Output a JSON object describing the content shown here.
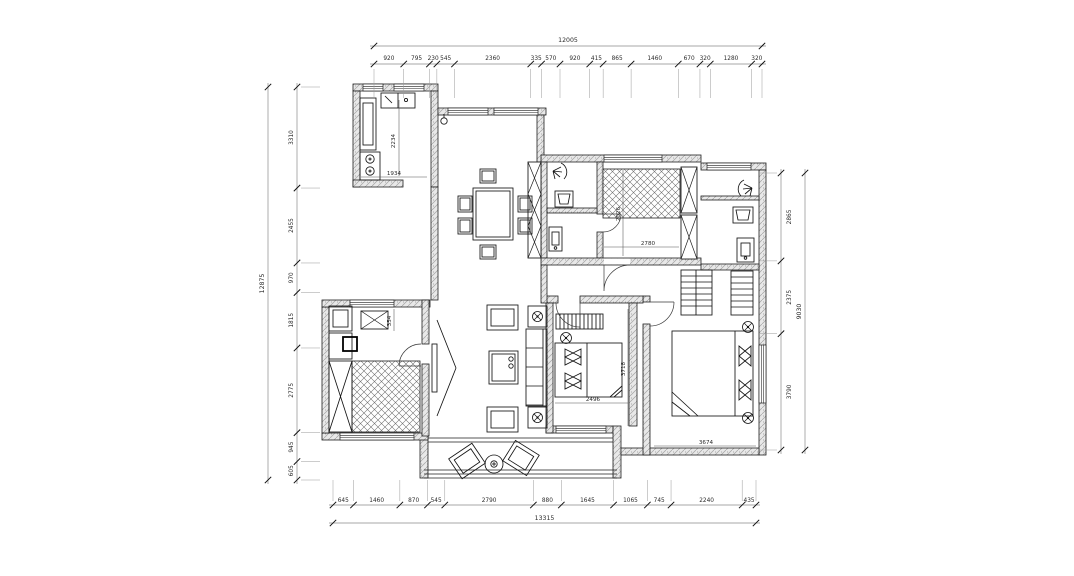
{
  "drawing": {
    "kind": "residential floor plan, dimensioned CAD drawing",
    "palette": {
      "background": "#ffffff",
      "wall_fill": "#e8e8e8",
      "wall_hatch": "#a3a3a3",
      "line": "#1f1f1f",
      "dim_line": "#8a8a8a",
      "dim_tick": "#111111",
      "dim_text": "#2a2a2a"
    },
    "dimensions": {
      "top": {
        "total": "12005",
        "segments": [
          "920",
          "795",
          "230",
          "545",
          "2360",
          "335",
          "570",
          "920",
          "415",
          "865",
          "1460",
          "670",
          "320",
          "1280",
          "320"
        ]
      },
      "bottom": {
        "total": "13315",
        "segments": [
          "645",
          "1460",
          "870",
          "545",
          "2790",
          "880",
          "1645",
          "1065",
          "745",
          "2240",
          "435"
        ]
      },
      "left": {
        "total": "12875",
        "segments": [
          "3310",
          "2455",
          "970",
          "1815",
          "2775",
          "945",
          "605"
        ]
      },
      "right": {
        "total": "9030",
        "segments": [
          "2865",
          "2375",
          "3790"
        ]
      }
    },
    "interior": {
      "kitchen_counter_length": "2234",
      "kitchen_counter_width": "1934",
      "cloakroom_width": "2780",
      "cloakroom_depth": "2026",
      "study_duct_width": "354",
      "bedroom_width": "2496",
      "bedroom_depth": "3718",
      "master_bedroom_width": "3674"
    }
  }
}
